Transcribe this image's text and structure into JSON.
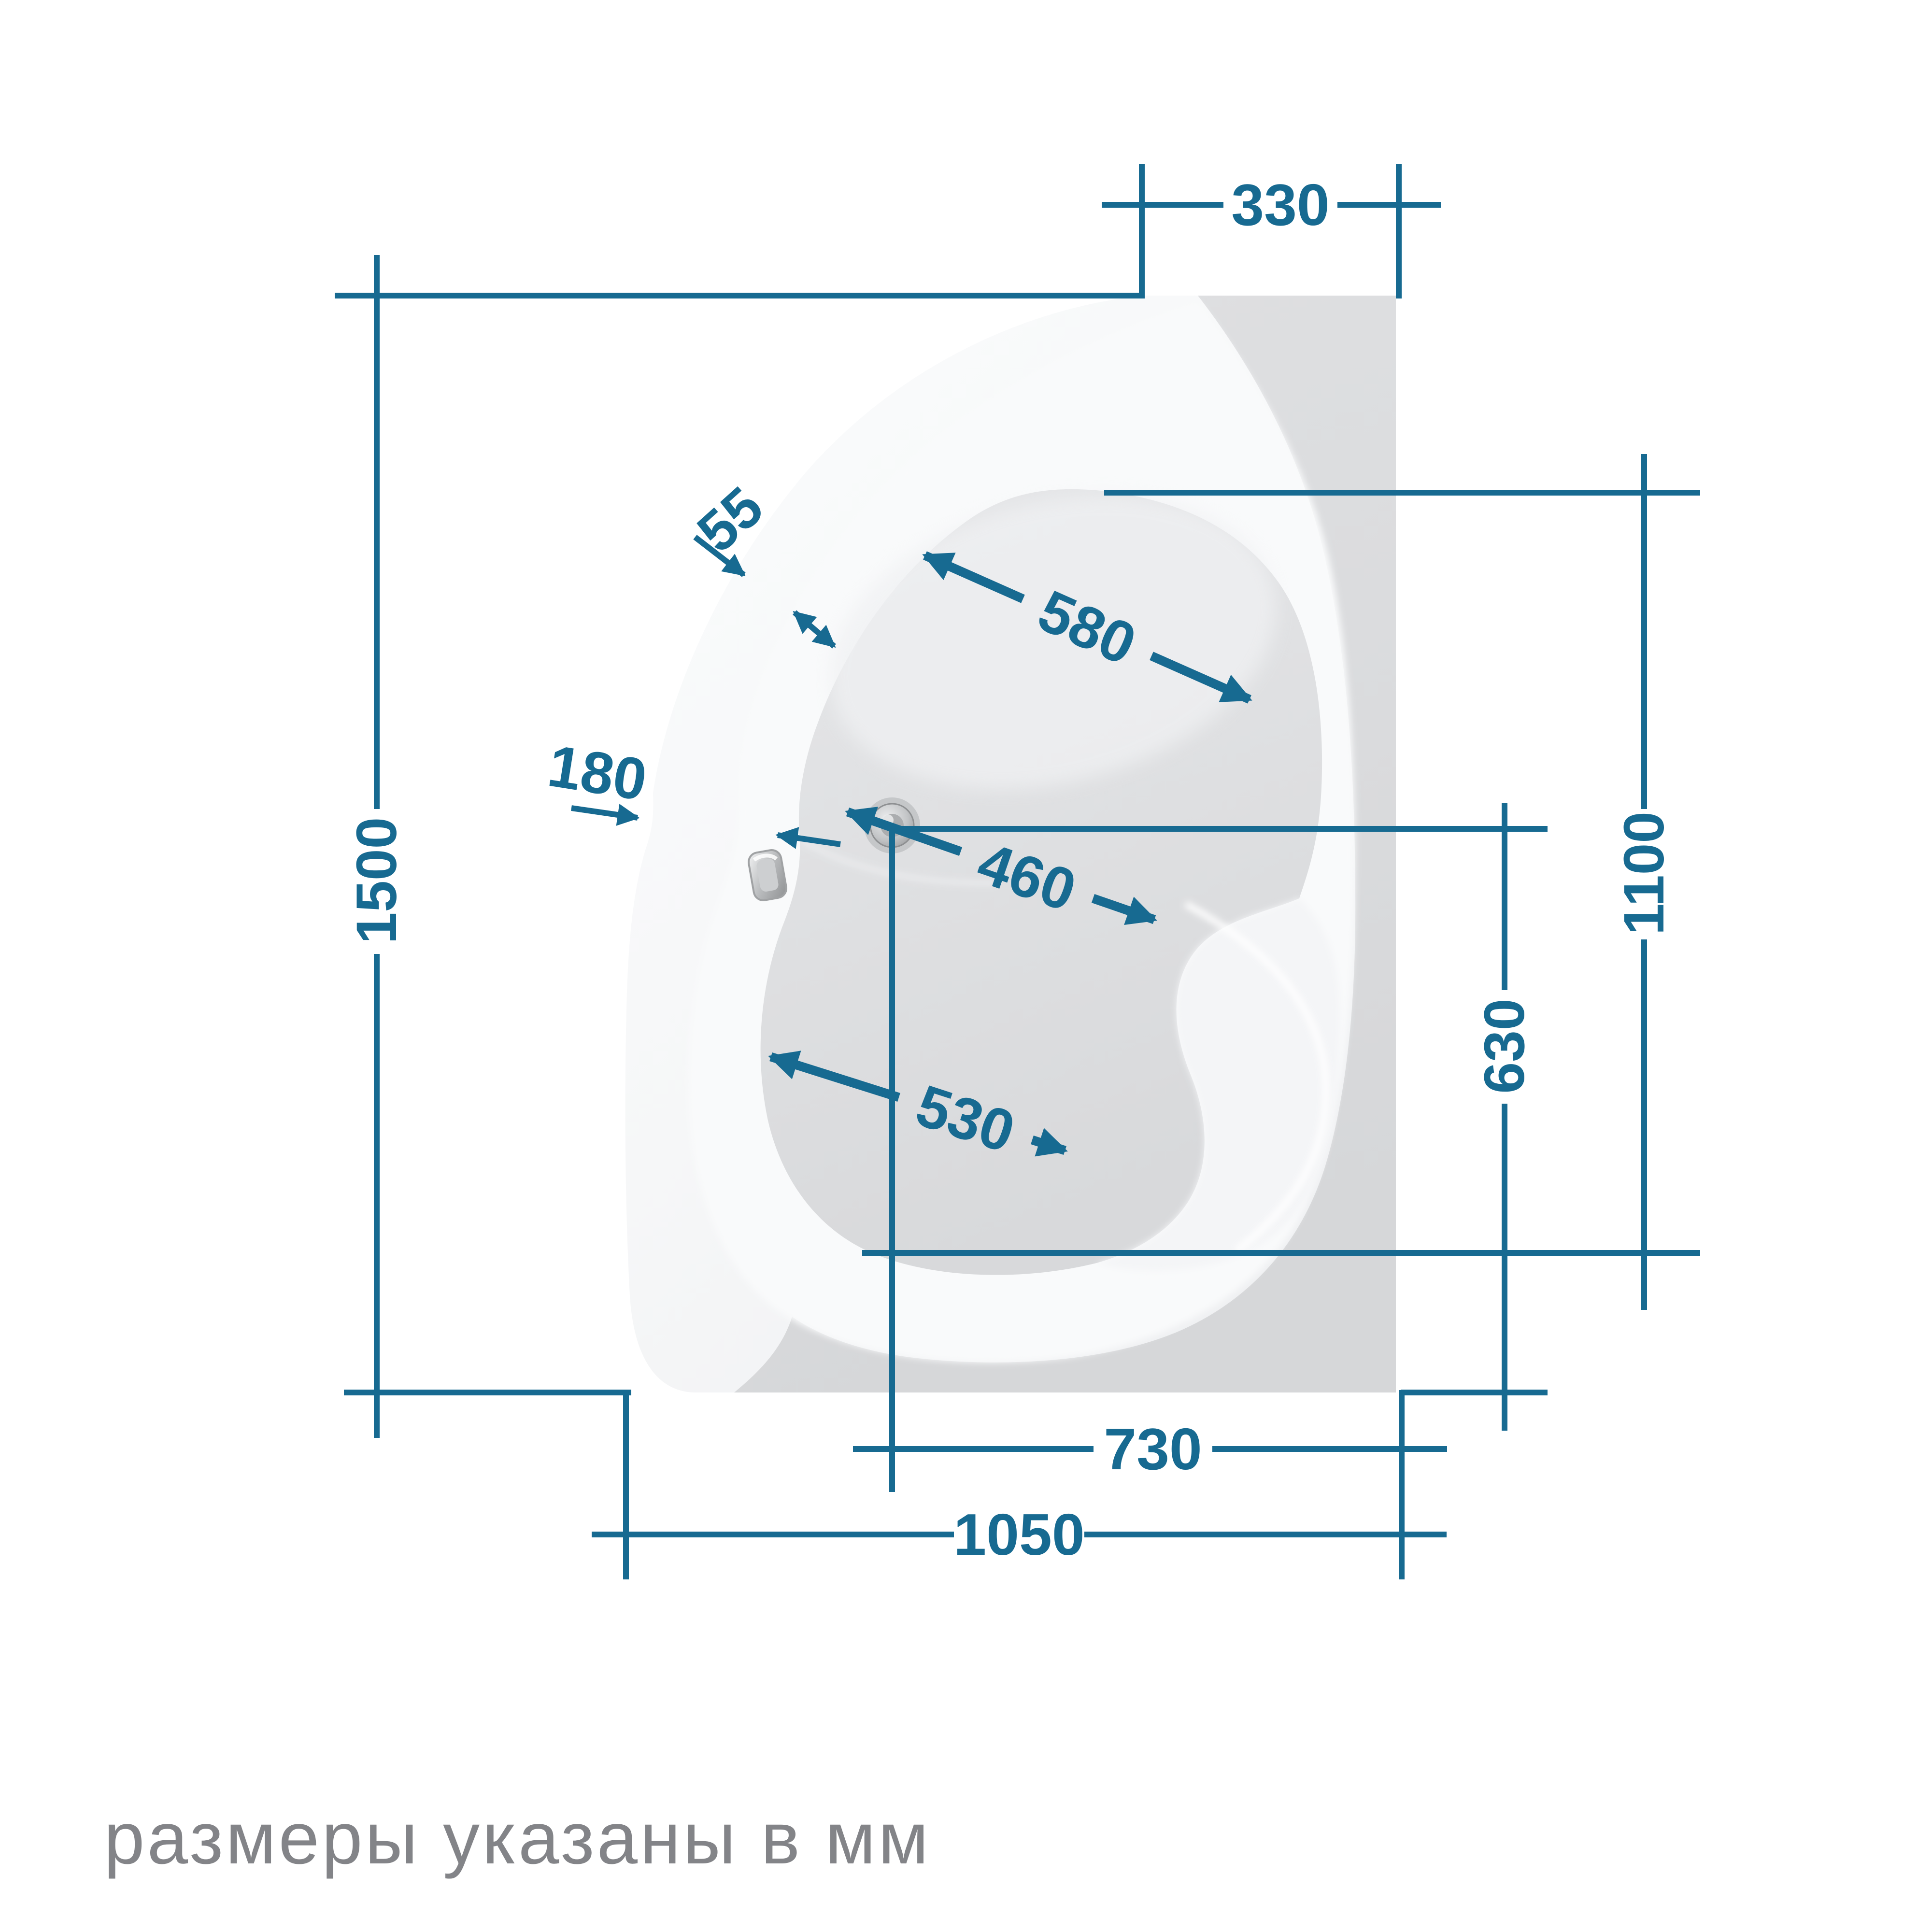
{
  "diagram": {
    "type": "bathtub-top-view-dimension-drawing",
    "unit_note": "размеры указаны в мм",
    "dimensions": {
      "corner_top_width": "330",
      "overall_length": "1500",
      "rim_width": "55",
      "apron_width": "180",
      "head_bowl_width": "580",
      "waist_width": "460",
      "inner_length": "1100",
      "foot_bowl_width": "530",
      "drain_to_edge": "630",
      "drain_to_wall": "730",
      "overall_width": "1050"
    },
    "colors": {
      "dimension_line": "#176A91",
      "note_text": "#838488",
      "deck_gray": "#DBDCDE",
      "bowl_floor": "#DFE0E2",
      "shell_white": "#FAFBFC"
    },
    "icons": {
      "drain": "drain-icon",
      "overflow": "overflow-icon"
    }
  }
}
